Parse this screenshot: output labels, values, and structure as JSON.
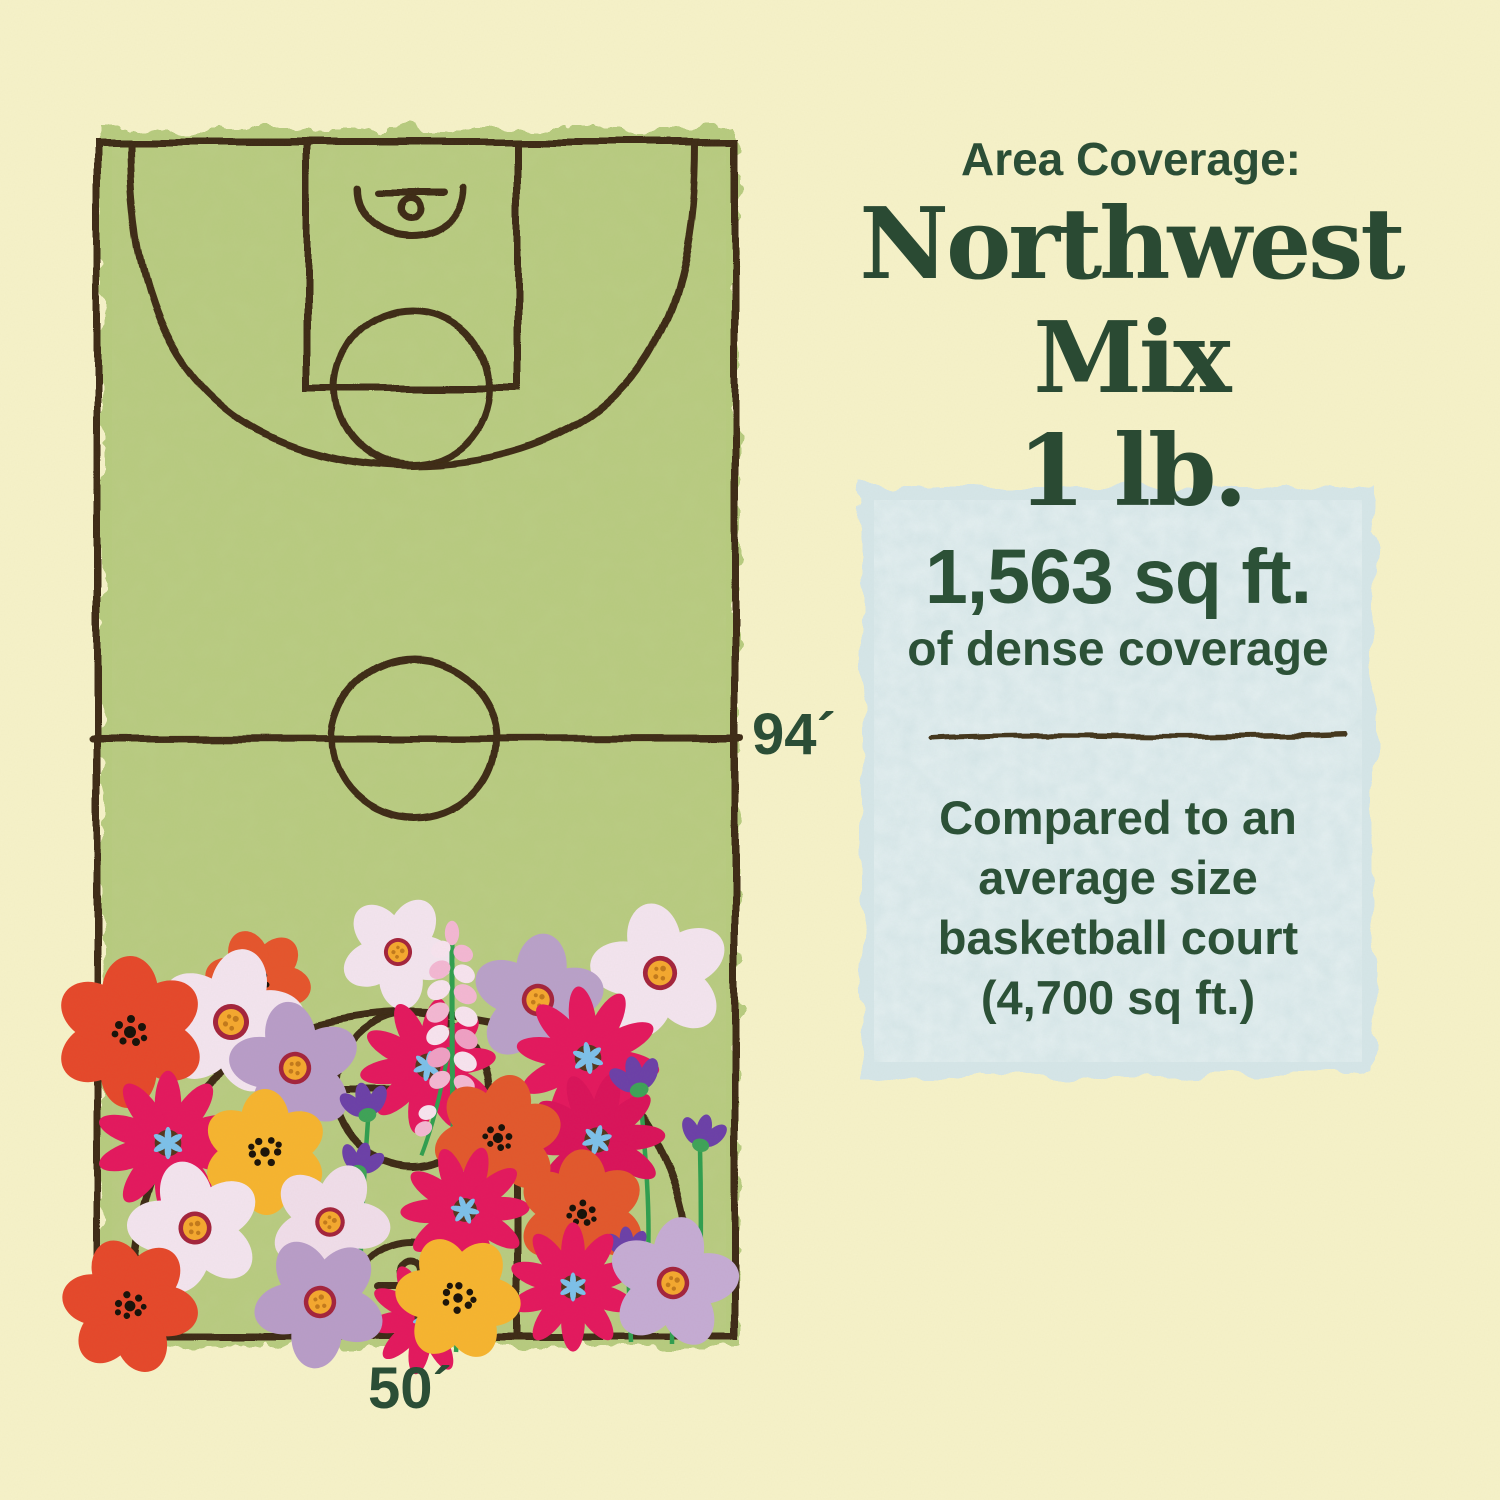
{
  "page": {
    "background_color": "#f6f2c9"
  },
  "header": {
    "eyebrow": "Area Coverage:",
    "product_name": "Northwest Mix",
    "product_size": "1 lb.",
    "text_color": "#2a4a33"
  },
  "court": {
    "length_label": "94´",
    "width_label": "50´",
    "fill_color": "#b7cb7f",
    "line_color": "#3c2b12",
    "description": "Hand-drawn basketball court illustration with wildflowers covering the lower third"
  },
  "coverage_card": {
    "background_color": "#d5e6e9",
    "headline": "1,563 sq ft.",
    "subheadline": "of dense coverage",
    "comparison_lines": [
      "Compared to an",
      "average size",
      "basketball court",
      "(4,700 sq ft.)"
    ]
  },
  "illustration": {
    "flower_types": [
      "red-poppy",
      "pink-cosmos",
      "white-daisy",
      "lavender-daisy",
      "yellow-wildflower",
      "purple-bud",
      "pink-lupine"
    ],
    "palette": {
      "poppy_red": "#e5472a",
      "poppy_orange": "#e2572c",
      "cosmos_pink": "#e3175e",
      "daisy_white": "#f3e4ef",
      "daisy_lavender": "#b89cc8",
      "flower_yellow": "#f6b42f",
      "bud_purple": "#6b3fa8",
      "stem_green": "#2f9e4f",
      "lupine_pink": "#f3b7d3"
    }
  }
}
